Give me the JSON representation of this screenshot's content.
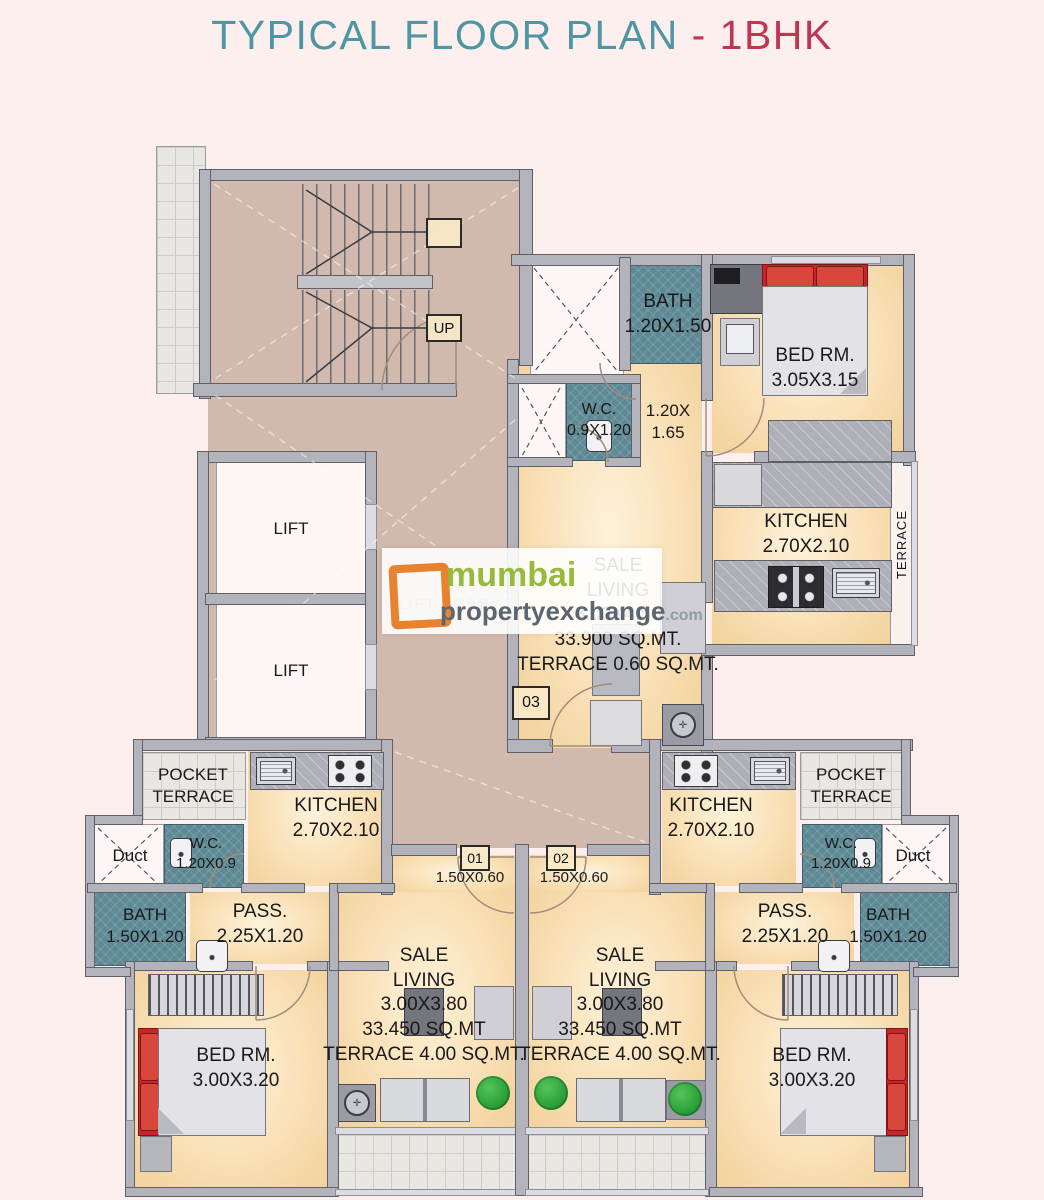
{
  "title": {
    "main": "TYPICAL FLOOR PLAN ",
    "accent": "- 1BHK"
  },
  "colors": {
    "accent_teal": "#4e96a3",
    "accent_red": "#c23550",
    "bath_teal": "#5d8994",
    "floor_cream": "#f8ddb4",
    "lobby_taupe": "#d2b9ae",
    "wall_gray": "#b2b3bb",
    "bed_red": "#c8242b",
    "plant_green": "#2fa43c",
    "watermark_orange": "#e8822f"
  },
  "watermark": {
    "brand": "mumbai",
    "domain": "propertyexchange",
    "tld": ".com"
  },
  "stairs": {
    "up": "UP"
  },
  "lobby": {
    "label": "LIFT LOBBY",
    "lift": "LIFT"
  },
  "unit3": {
    "number": "03",
    "bath_name": "BATH",
    "bath_dim": "1.20X1.50",
    "wc_name": "W.C.",
    "wc_dim": "0.9X1.20",
    "pass_dim1": "1.20X",
    "pass_dim2": "1.65",
    "bed_name": "BED RM.",
    "bed_dim": "3.05X3.15",
    "kitchen_name": "KITCHEN",
    "kitchen_dim": "2.70X2.10",
    "terrace": "TERRACE",
    "living": {
      "l1": "SALE",
      "l2": "LIVING",
      "l3": "3.00X4.50",
      "l4": "33.900 SQ.MT.",
      "l5": "TERRACE 0.60 SQ.MT."
    }
  },
  "unit1": {
    "number": "01",
    "entry_dim": "1.50X0.60",
    "pocket1": "POCKET",
    "pocket2": "TERRACE",
    "duct": "Duct",
    "wc_name": "W.C.",
    "wc_dim": "1.20X0.9",
    "kitchen_name": "KITCHEN",
    "kitchen_dim": "2.70X2.10",
    "bath_name": "BATH",
    "bath_dim": "1.50X1.20",
    "pass_name": "PASS.",
    "pass_dim": "2.25X1.20",
    "bed_name": "BED RM.",
    "bed_dim": "3.00X3.20",
    "living": {
      "l1": "SALE",
      "l2": "LIVING",
      "l3": "3.00X3.80",
      "l4": "33.450 SQ.MT",
      "l5": "TERRACE 4.00 SQ.MT."
    }
  },
  "unit2": {
    "number": "02",
    "entry_dim": "1.50X0.60",
    "pocket1": "POCKET",
    "pocket2": "TERRACE",
    "duct": "Duct",
    "wc_name": "W.C.",
    "wc_dim": "1.20X0.9",
    "kitchen_name": "KITCHEN",
    "kitchen_dim": "2.70X2.10",
    "bath_name": "BATH",
    "bath_dim": "1.50X1.20",
    "pass_name": "PASS.",
    "pass_dim": "2.25X1.20",
    "bed_name": "BED RM.",
    "bed_dim": "3.00X3.20",
    "living": {
      "l1": "SALE",
      "l2": "LIVING",
      "l3": "3.00X3.80",
      "l4": "33.450 SQ.MT",
      "l5": "TERRACE 4.00 SQ.MT."
    }
  }
}
